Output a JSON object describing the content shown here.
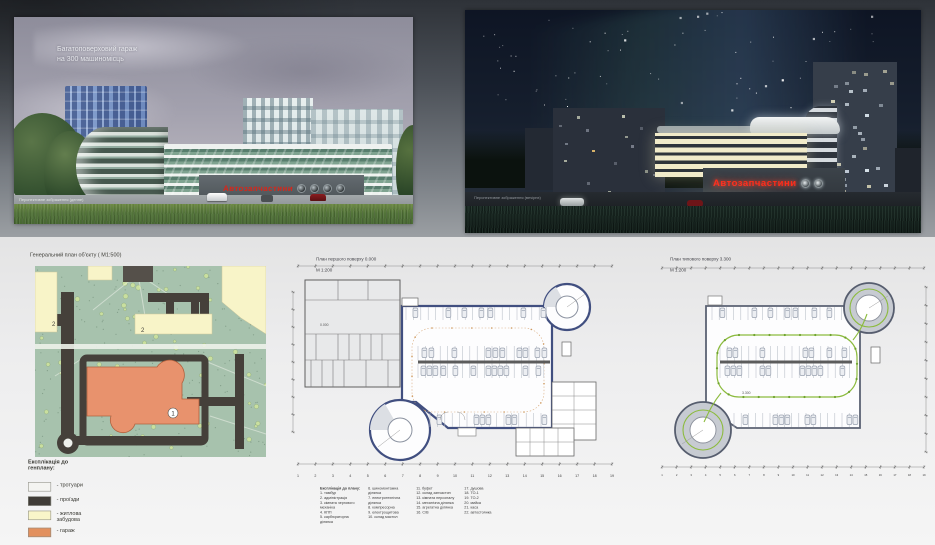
{
  "day_render": {
    "title_line1": "Багатоповерховий гараж",
    "title_line2": "на 300 машиномісць",
    "caption": "Перспективне зображення (денне)",
    "sign": "Автозапчастини"
  },
  "night_render": {
    "caption": "Перспективне зображення (вечірнє)",
    "sign": "Автозапчастини"
  },
  "siteplan": {
    "title": "Генеральний план об'єкту ( М1:500)",
    "marker_garage": "1",
    "marker_residential_a": "2",
    "marker_residential_b": "2",
    "legend_title": "Експлікація до\nгенплану:",
    "legend_items": [
      {
        "color": "#f4f4f1",
        "label": "- тротуари"
      },
      {
        "color": "#403c37",
        "label": "- проїзди"
      },
      {
        "color": "#f9f5c9",
        "label": "- житлова\nзабудова"
      },
      {
        "color": "#e2905e",
        "label": "- гараж"
      }
    ]
  },
  "plan_first": {
    "title": "План першого поверху 0.000",
    "scale": "М 1:200",
    "level_mark": "0.000",
    "axis_labels": [
      "1",
      "2",
      "3",
      "4",
      "5",
      "6",
      "7",
      "8",
      "9",
      "10",
      "11",
      "12",
      "13",
      "14",
      "15",
      "16",
      "17",
      "18",
      "19"
    ],
    "legend_title": "Експлікація до плану:",
    "legend_columns": [
      [
        "1. тамбур",
        "2. адміністрація",
        "3. кімната чергового механіка",
        "4. КПП",
        "5. карбюраторна ділянка"
      ],
      [
        "6. шиномонтажна ділянка",
        "7. електротехнічна ділянка",
        "8. компресорна",
        "9. електрощитова",
        "10. склад мастил"
      ],
      [
        "11. буфет",
        "12. склад запчастин",
        "13. кімната персоналу",
        "14. механічна ділянка",
        "15. агрегатна ділянка",
        "16. С/В"
      ],
      [
        "17. душова",
        "18. ТО-1",
        "19. ТО-2",
        "20. мийка",
        "21. каса",
        "22. автостоянка"
      ]
    ]
  },
  "plan_typical": {
    "title": "План типового поверху 3.300",
    "scale": "М 1:200",
    "level_mark": "3.300"
  }
}
